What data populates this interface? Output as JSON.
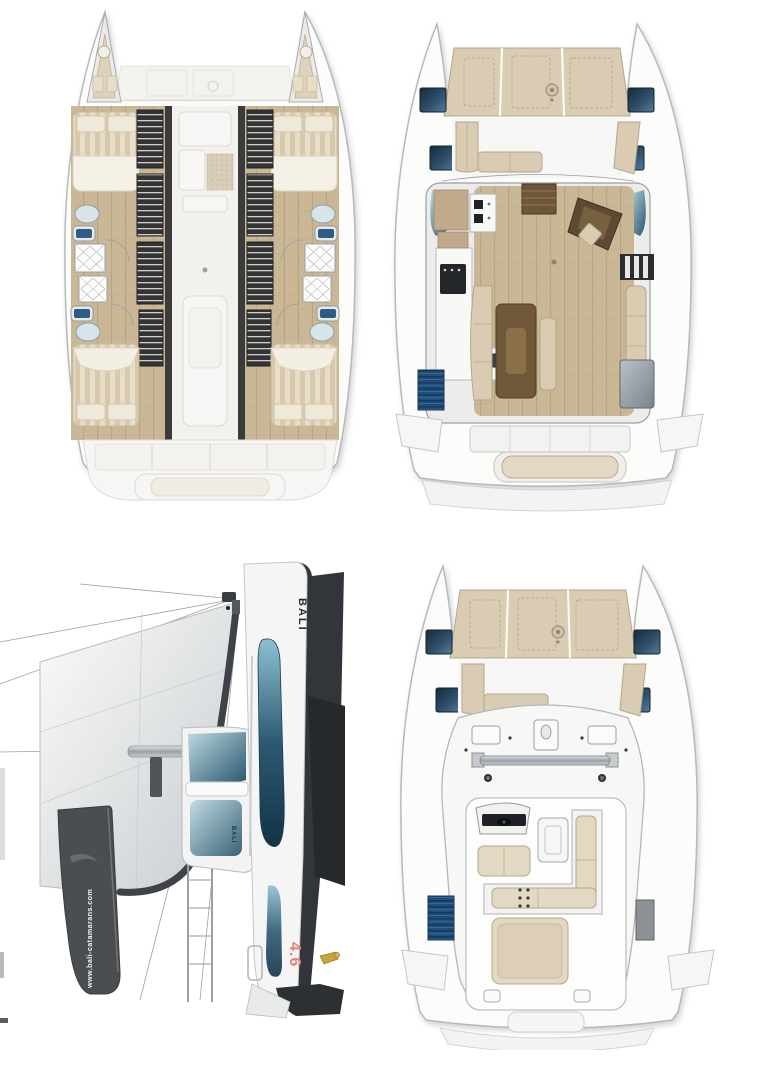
{
  "page": {
    "background": "#ffffff"
  },
  "panels": {
    "lower_deck": {
      "name": "Lower deck cabins plan"
    },
    "main_deck": {
      "name": "Main deck saloon plan"
    },
    "profile": {
      "name": "Sailing profile view"
    },
    "flybridge": {
      "name": "Flybridge deck plan"
    }
  },
  "branding": {
    "hull_logo": "BALI",
    "model": "4.6",
    "website": "www.bali-catamarans.com",
    "coachroof_logo": "BALI"
  },
  "palette": {
    "page_bg": "#ffffff",
    "cushion_beige": "#d9ccb3",
    "cushion_border": "#b3a68c",
    "wood_floor": "#c9b795",
    "dark_wall": "#3b3b3b",
    "window_blue": "#2e4f6b",
    "teal_window": "#2c5a72",
    "sail_grey": "#dfe2e4",
    "charcoal": "#4b4e50",
    "model_red": "#e4807b",
    "anchor_gold": "#c9a43c",
    "ghost_grey": "#f1f0ed"
  }
}
